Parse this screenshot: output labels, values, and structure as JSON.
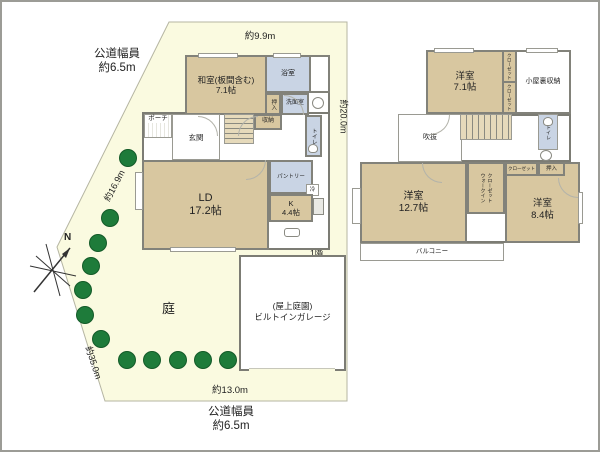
{
  "site": {
    "road_top_line1": "公道幅員",
    "road_top_line2": "約6.5m",
    "road_bottom_line1": "公道幅員",
    "road_bottom_line2": "約6.5m",
    "dim_top": "約9.9m",
    "dim_right": "約20.0m",
    "dim_bottom": "約13.0m",
    "dim_diag_upper": "約16.9m",
    "dim_diag_lower": "約35.0m",
    "garden": "庭",
    "compass": "N",
    "floor1_tag": "1階"
  },
  "floor1": {
    "washitsu_name": "和室(板間含む)",
    "washitsu_size": "7.1帖",
    "bath": "浴室",
    "senmen": "洗面室",
    "oshiire": "押入",
    "toilet": "トイレ",
    "shuno": "収納",
    "porch": "ポーチ",
    "genkan": "玄関",
    "ld_name": "LD",
    "ld_size": "17.2帖",
    "pantry": "パントリー",
    "fridge": "冷",
    "kitchen_name": "K",
    "kitchen_size": "4.4帖",
    "garage_line1": "(屋上庭園)",
    "garage_line2": "ビルトインガレージ"
  },
  "floor2": {
    "room1_name": "洋室",
    "room1_size": "7.1帖",
    "closet_a": "クローゼット",
    "closet_b": "クローゼット",
    "attic": "小屋裏収納",
    "void": "吹抜",
    "toilet": "トイレ",
    "room2_name": "洋室",
    "room2_size": "12.7帖",
    "wic_line1": "ウォークイン",
    "wic_line2": "クローゼット",
    "closet_c": "クローゼット",
    "oshiire": "押入",
    "room3_name": "洋室",
    "room3_size": "8.4帖",
    "balcony": "バルコニー"
  },
  "colors": {
    "lot_fill": "#fafae0",
    "room_tan": "#d8c7a0",
    "room_blue": "#c9d4e4",
    "wall_gray": "#82827a",
    "tree_green": "#1e7b3a"
  }
}
